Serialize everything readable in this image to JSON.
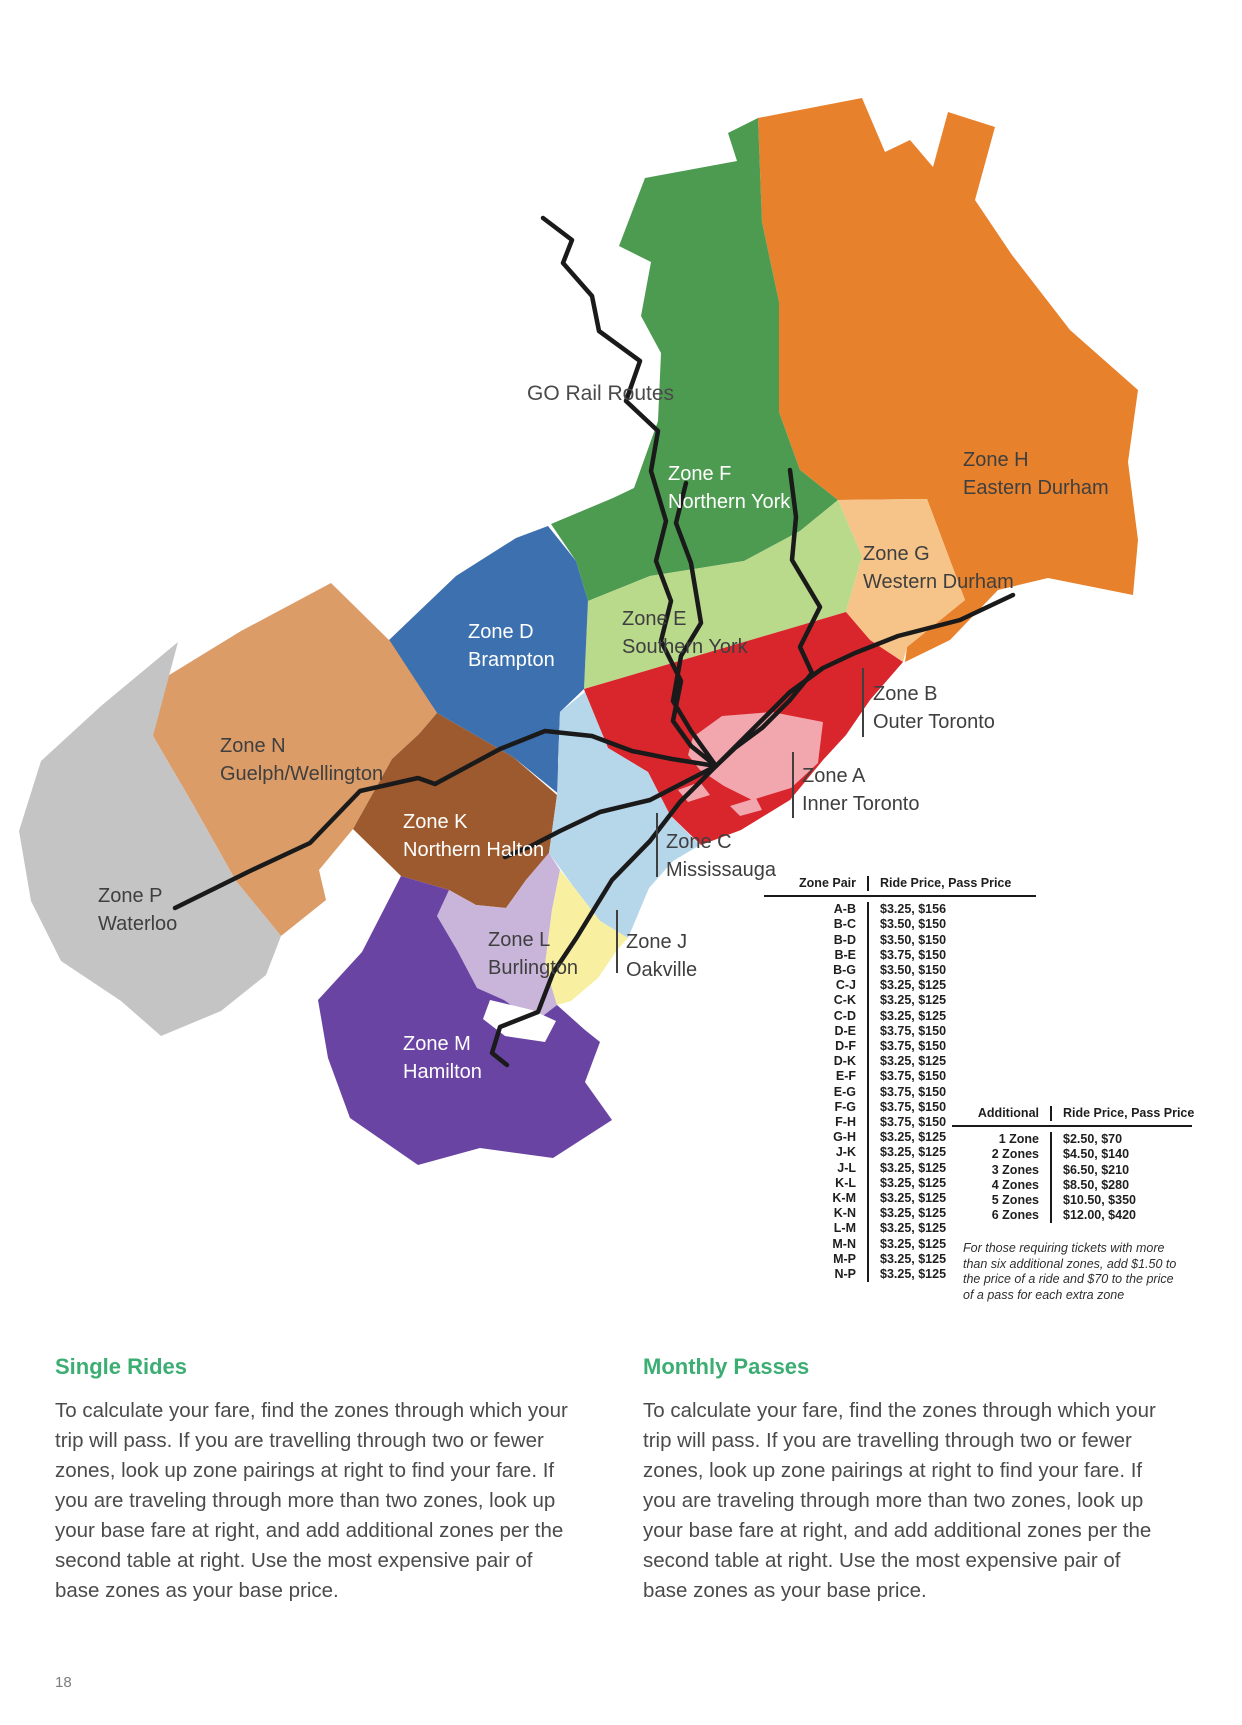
{
  "page_number": "18",
  "map": {
    "legend_label": "GO Rail Routes",
    "rail_color": "#1a1a1a",
    "zones": {
      "A": {
        "label": "Zone A",
        "sublabel": "Inner Toronto",
        "color": "#f2a6ae"
      },
      "B": {
        "label": "Zone B",
        "sublabel": "Outer Toronto",
        "color": "#d9262c"
      },
      "C": {
        "label": "Zone C",
        "sublabel": "Mississauga",
        "color": "#b6d6ea"
      },
      "D": {
        "label": "Zone D",
        "sublabel": "Brampton",
        "color": "#3c70af"
      },
      "E": {
        "label": "Zone E",
        "sublabel": "Southern York",
        "color": "#b9d98b"
      },
      "F": {
        "label": "Zone F",
        "sublabel": "Northern York",
        "color": "#4d9b51"
      },
      "G": {
        "label": "Zone G",
        "sublabel": "Western Durham",
        "color": "#f6c488"
      },
      "H": {
        "label": "Zone H",
        "sublabel": "Eastern Durham",
        "color": "#e8812c"
      },
      "J": {
        "label": "Zone J",
        "sublabel": "Oakville",
        "color": "#f8f0a0"
      },
      "K": {
        "label": "Zone K",
        "sublabel": "Northern Halton",
        "color": "#9d5a2e"
      },
      "L": {
        "label": "Zone L",
        "sublabel": "Burlington",
        "color": "#c9b5da"
      },
      "M": {
        "label": "Zone M",
        "sublabel": "Hamilton",
        "color": "#6a44a3"
      },
      "N": {
        "label": "Zone N",
        "sublabel": "Guelph/Wellington",
        "color": "#dc9c67"
      },
      "P": {
        "label": "Zone P",
        "sublabel": "Waterloo",
        "color": "#c4c4c4"
      }
    }
  },
  "fare_table": {
    "headers": [
      "Zone Pair",
      "Ride Price, Pass Price"
    ],
    "rows": [
      [
        "A-B",
        "$3.25, $156"
      ],
      [
        "B-C",
        "$3.50, $150"
      ],
      [
        "B-D",
        "$3.50, $150"
      ],
      [
        "B-E",
        "$3.75, $150"
      ],
      [
        "B-G",
        "$3.50, $150"
      ],
      [
        "C-J",
        "$3.25, $125"
      ],
      [
        "C-K",
        "$3.25, $125"
      ],
      [
        "C-D",
        "$3.25, $125"
      ],
      [
        "D-E",
        "$3.75, $150"
      ],
      [
        "D-F",
        "$3.75, $150"
      ],
      [
        "D-K",
        "$3.25, $125"
      ],
      [
        "E-F",
        "$3.75, $150"
      ],
      [
        "E-G",
        "$3.75, $150"
      ],
      [
        "F-G",
        "$3.75, $150"
      ],
      [
        "F-H",
        "$3.75, $150"
      ],
      [
        "G-H",
        "$3.25, $125"
      ],
      [
        "J-K",
        "$3.25, $125"
      ],
      [
        "J-L",
        "$3.25, $125"
      ],
      [
        "K-L",
        "$3.25, $125"
      ],
      [
        "K-M",
        "$3.25, $125"
      ],
      [
        "K-N",
        "$3.25, $125"
      ],
      [
        "L-M",
        "$3.25, $125"
      ],
      [
        "M-N",
        "$3.25, $125"
      ],
      [
        "M-P",
        "$3.25, $125"
      ],
      [
        "N-P",
        "$3.25, $125"
      ]
    ]
  },
  "additional_table": {
    "headers": [
      "Additional",
      "Ride Price, Pass Price"
    ],
    "rows": [
      [
        "1 Zone",
        "$2.50, $70"
      ],
      [
        "2 Zones",
        "$4.50, $140"
      ],
      [
        "3 Zones",
        "$6.50, $210"
      ],
      [
        "4 Zones",
        "$8.50, $280"
      ],
      [
        "5 Zones",
        "$10.50, $350"
      ],
      [
        "6 Zones",
        "$12.00, $420"
      ]
    ]
  },
  "footnote": "For those requiring tickets with more than six additional zones, add $1.50 to the price of a ride and $70 to the price of a pass for each extra zone",
  "sections": {
    "single": {
      "title": "Single Rides",
      "body": "To calculate your fare, find the zones through which your trip will pass. If you are travelling through two or fewer zones, look up zone pairings at right to find your fare. If you are traveling through more than two zones, look up your base fare at right, and add additional zones per the second table at right. Use the most expensive pair of base zones as your base price."
    },
    "monthly": {
      "title": "Monthly Passes",
      "body": "To calculate your fare, find the zones through which your trip will pass. If you are travelling through two or fewer zones, look up zone pairings at right to find your fare. If you are traveling through more than two zones, look up your base fare at right, and add additional zones per the second table at right. Use the most expensive pair of base zones as your base price."
    }
  }
}
